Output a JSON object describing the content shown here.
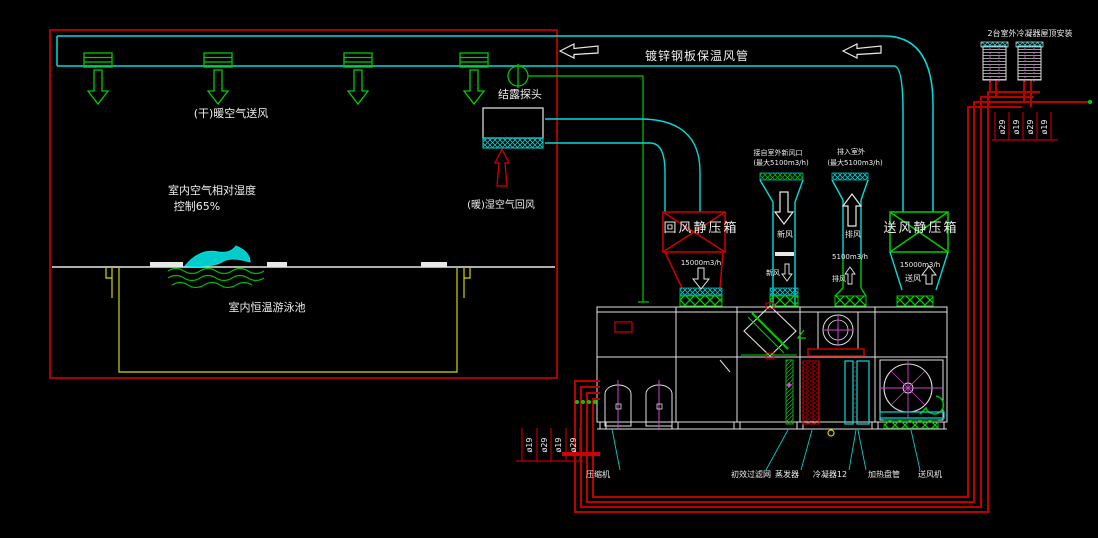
{
  "colors": {
    "background": "#000000",
    "duct_cyan": "#00dcdc",
    "diffuser_green": "#00cc00",
    "room_red": "#d00000",
    "pipe_red": "#bb0000",
    "pool_yellow": "#d6d600",
    "magenta": "#cc44cc",
    "text_white": "#ededed"
  },
  "room": {
    "supply_label": "(干)暖空气送风",
    "humidity_label_1": "室内空气相对湿度",
    "humidity_label_2": "控制65%",
    "pool_label": "室内恒温游泳池",
    "return_label": "(暖)湿空气回风"
  },
  "duct": {
    "main_label": "镀锌钢板保温风管",
    "probe_label": "结露探头"
  },
  "plenums": {
    "return_label": "回风静压箱",
    "return_flow": "15000m3/h",
    "supply_label": "送风静压箱",
    "supply_flow": "15000m3/h",
    "supply_dir": "送风"
  },
  "outside": {
    "fresh_title": "接自室外新风口",
    "fresh_max": "(最大5100m3/h)",
    "fresh_dir": "新风",
    "fresh_small": "新风",
    "exhaust_title": "排入室外",
    "exhaust_max": "(最大5100m3/h)",
    "exhaust_dir": "排风",
    "exhaust_flow": "5100m3/h",
    "exhaust_small": "排风",
    "condenser_label": "2台室外冷凝器屋顶安装"
  },
  "pipes": {
    "right_sizes": [
      "ø29",
      "ø19",
      "ø29",
      "ø19"
    ],
    "left_sizes": [
      "ø19",
      "ø29",
      "ø19",
      "ø29"
    ]
  },
  "ahu": {
    "components": [
      "压缩机",
      "初效过滤网",
      "蒸发器",
      "冷凝器12",
      "加热盘管",
      "送风机"
    ]
  }
}
